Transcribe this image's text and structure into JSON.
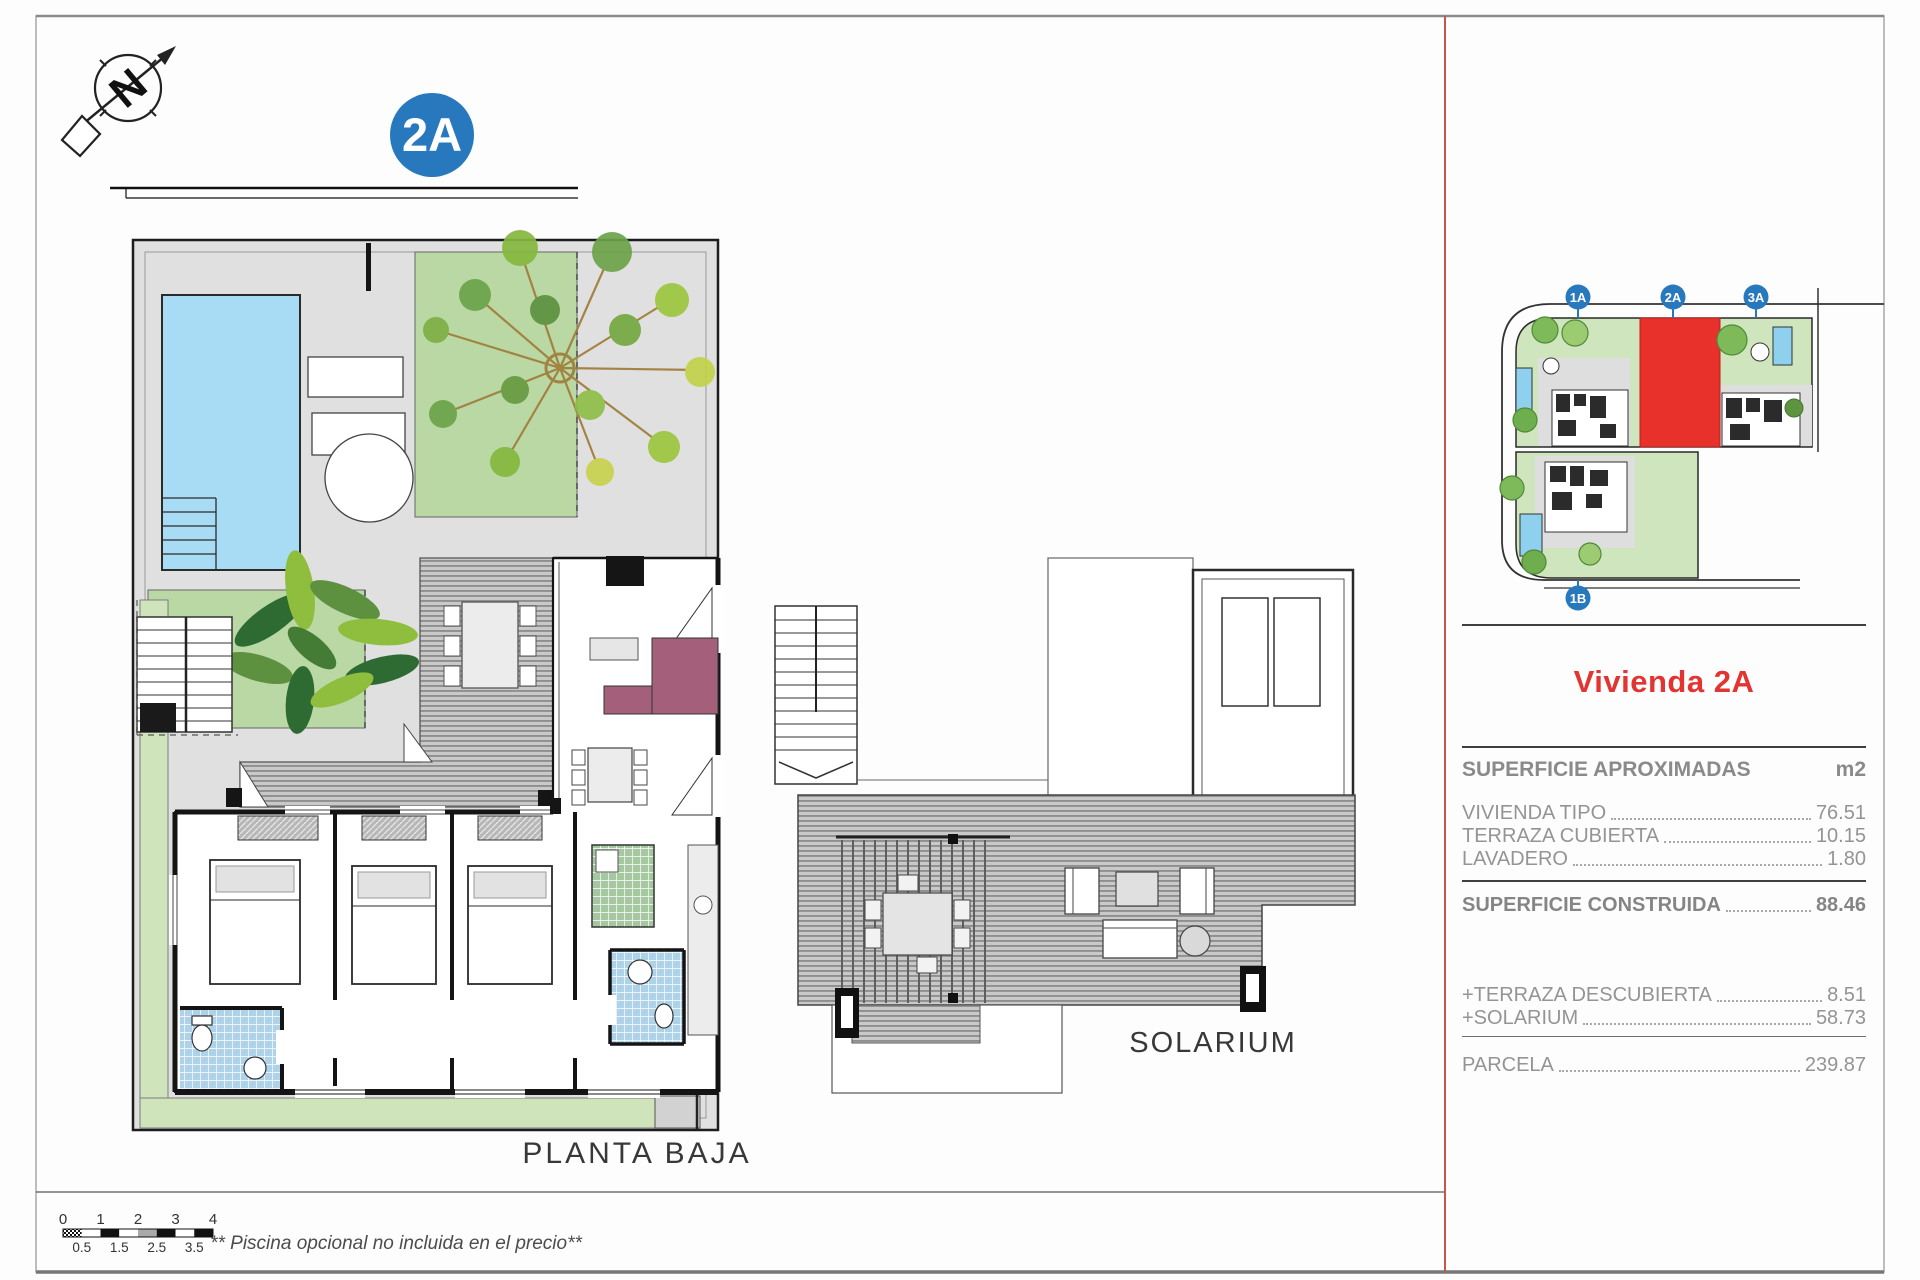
{
  "page": {
    "unit_badge": "2A",
    "ground_floor_label": "PLANTA BAJA",
    "solarium_label": "SOLARIUM",
    "footnote": "** Piscina opcional no incluida en el precio**",
    "colors": {
      "badge_blue": "#2878be",
      "highlight_red": "#e8312a",
      "title_red": "#e23430",
      "pool_blue": "#a8dcf4",
      "divider_red": "#c4574a"
    }
  },
  "site_plan": {
    "units": [
      {
        "label": "1A"
      },
      {
        "label": "2A"
      },
      {
        "label": "3A"
      },
      {
        "label": "1B"
      }
    ],
    "highlighted_unit": "2A"
  },
  "scale_bar": {
    "major_ticks": [
      "0",
      "1",
      "2",
      "3",
      "4"
    ],
    "minor_ticks": [
      "0.5",
      "1.5",
      "2.5",
      "3.5"
    ]
  },
  "panel": {
    "title": "Vivienda 2A",
    "section_header": "SUPERFICIE APROXIMADAS",
    "unit_label": "m2",
    "rows": [
      {
        "label": "VIVIENDA TIPO",
        "value": "76.51"
      },
      {
        "label": "TERRAZA CUBIERTA",
        "value": "10.15"
      },
      {
        "label": "LAVADERO",
        "value": "1.80"
      }
    ],
    "total": {
      "label": "SUPERFICIE CONSTRUIDA",
      "value": "88.46"
    },
    "additions": [
      {
        "label": "+TERRAZA DESCUBIERTA",
        "value": "8.51"
      },
      {
        "label": "+SOLARIUM",
        "value": "58.73"
      }
    ],
    "parcel": {
      "label": "PARCELA",
      "value": "239.87"
    }
  }
}
